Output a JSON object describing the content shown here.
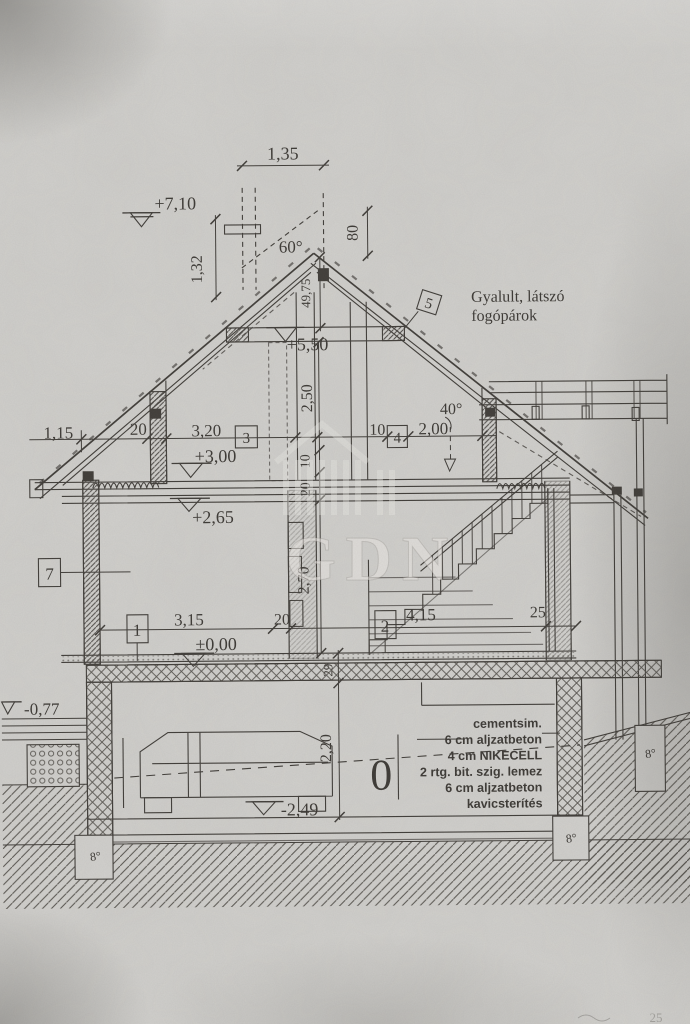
{
  "texts": {
    "note1": "Gyalult, látszó",
    "note2": "fogópárok",
    "layers": [
      "cementsim.",
      "6 cm aljzatbeton",
      "4 cm NIKECELL",
      "2 rtg. bit. szig. lemez",
      "6 cm aljzatbeton",
      "kavicsterítés"
    ],
    "levels": {
      "l710": "+7,10",
      "l550": "+5,50",
      "l300": "+3,00",
      "l265": "+2,65",
      "l000": "±0,00",
      "lm077": "-0,77",
      "lm249": "-2,49"
    },
    "angles": {
      "a60": "60°",
      "a40": "40°"
    },
    "dims": {
      "d135": "1,35",
      "d132": "1,32",
      "d80": "80",
      "d4975": "49,75",
      "d250": "2,50",
      "d115": "1,15",
      "d20": "20",
      "d320": "3,20",
      "d10": "10",
      "d200": "2,00",
      "d270": "2,70",
      "d315": "3,15",
      "d415": "4,15",
      "d25": "25",
      "d29": "29",
      "d220": "2,20"
    },
    "markers": {
      "m0": "0",
      "m1": "1",
      "m2": "2",
      "m3": "3",
      "m4": "4",
      "m5": "5",
      "m7": "7",
      "footing": "8°"
    },
    "watermark": "GDN",
    "fragment": "25"
  }
}
